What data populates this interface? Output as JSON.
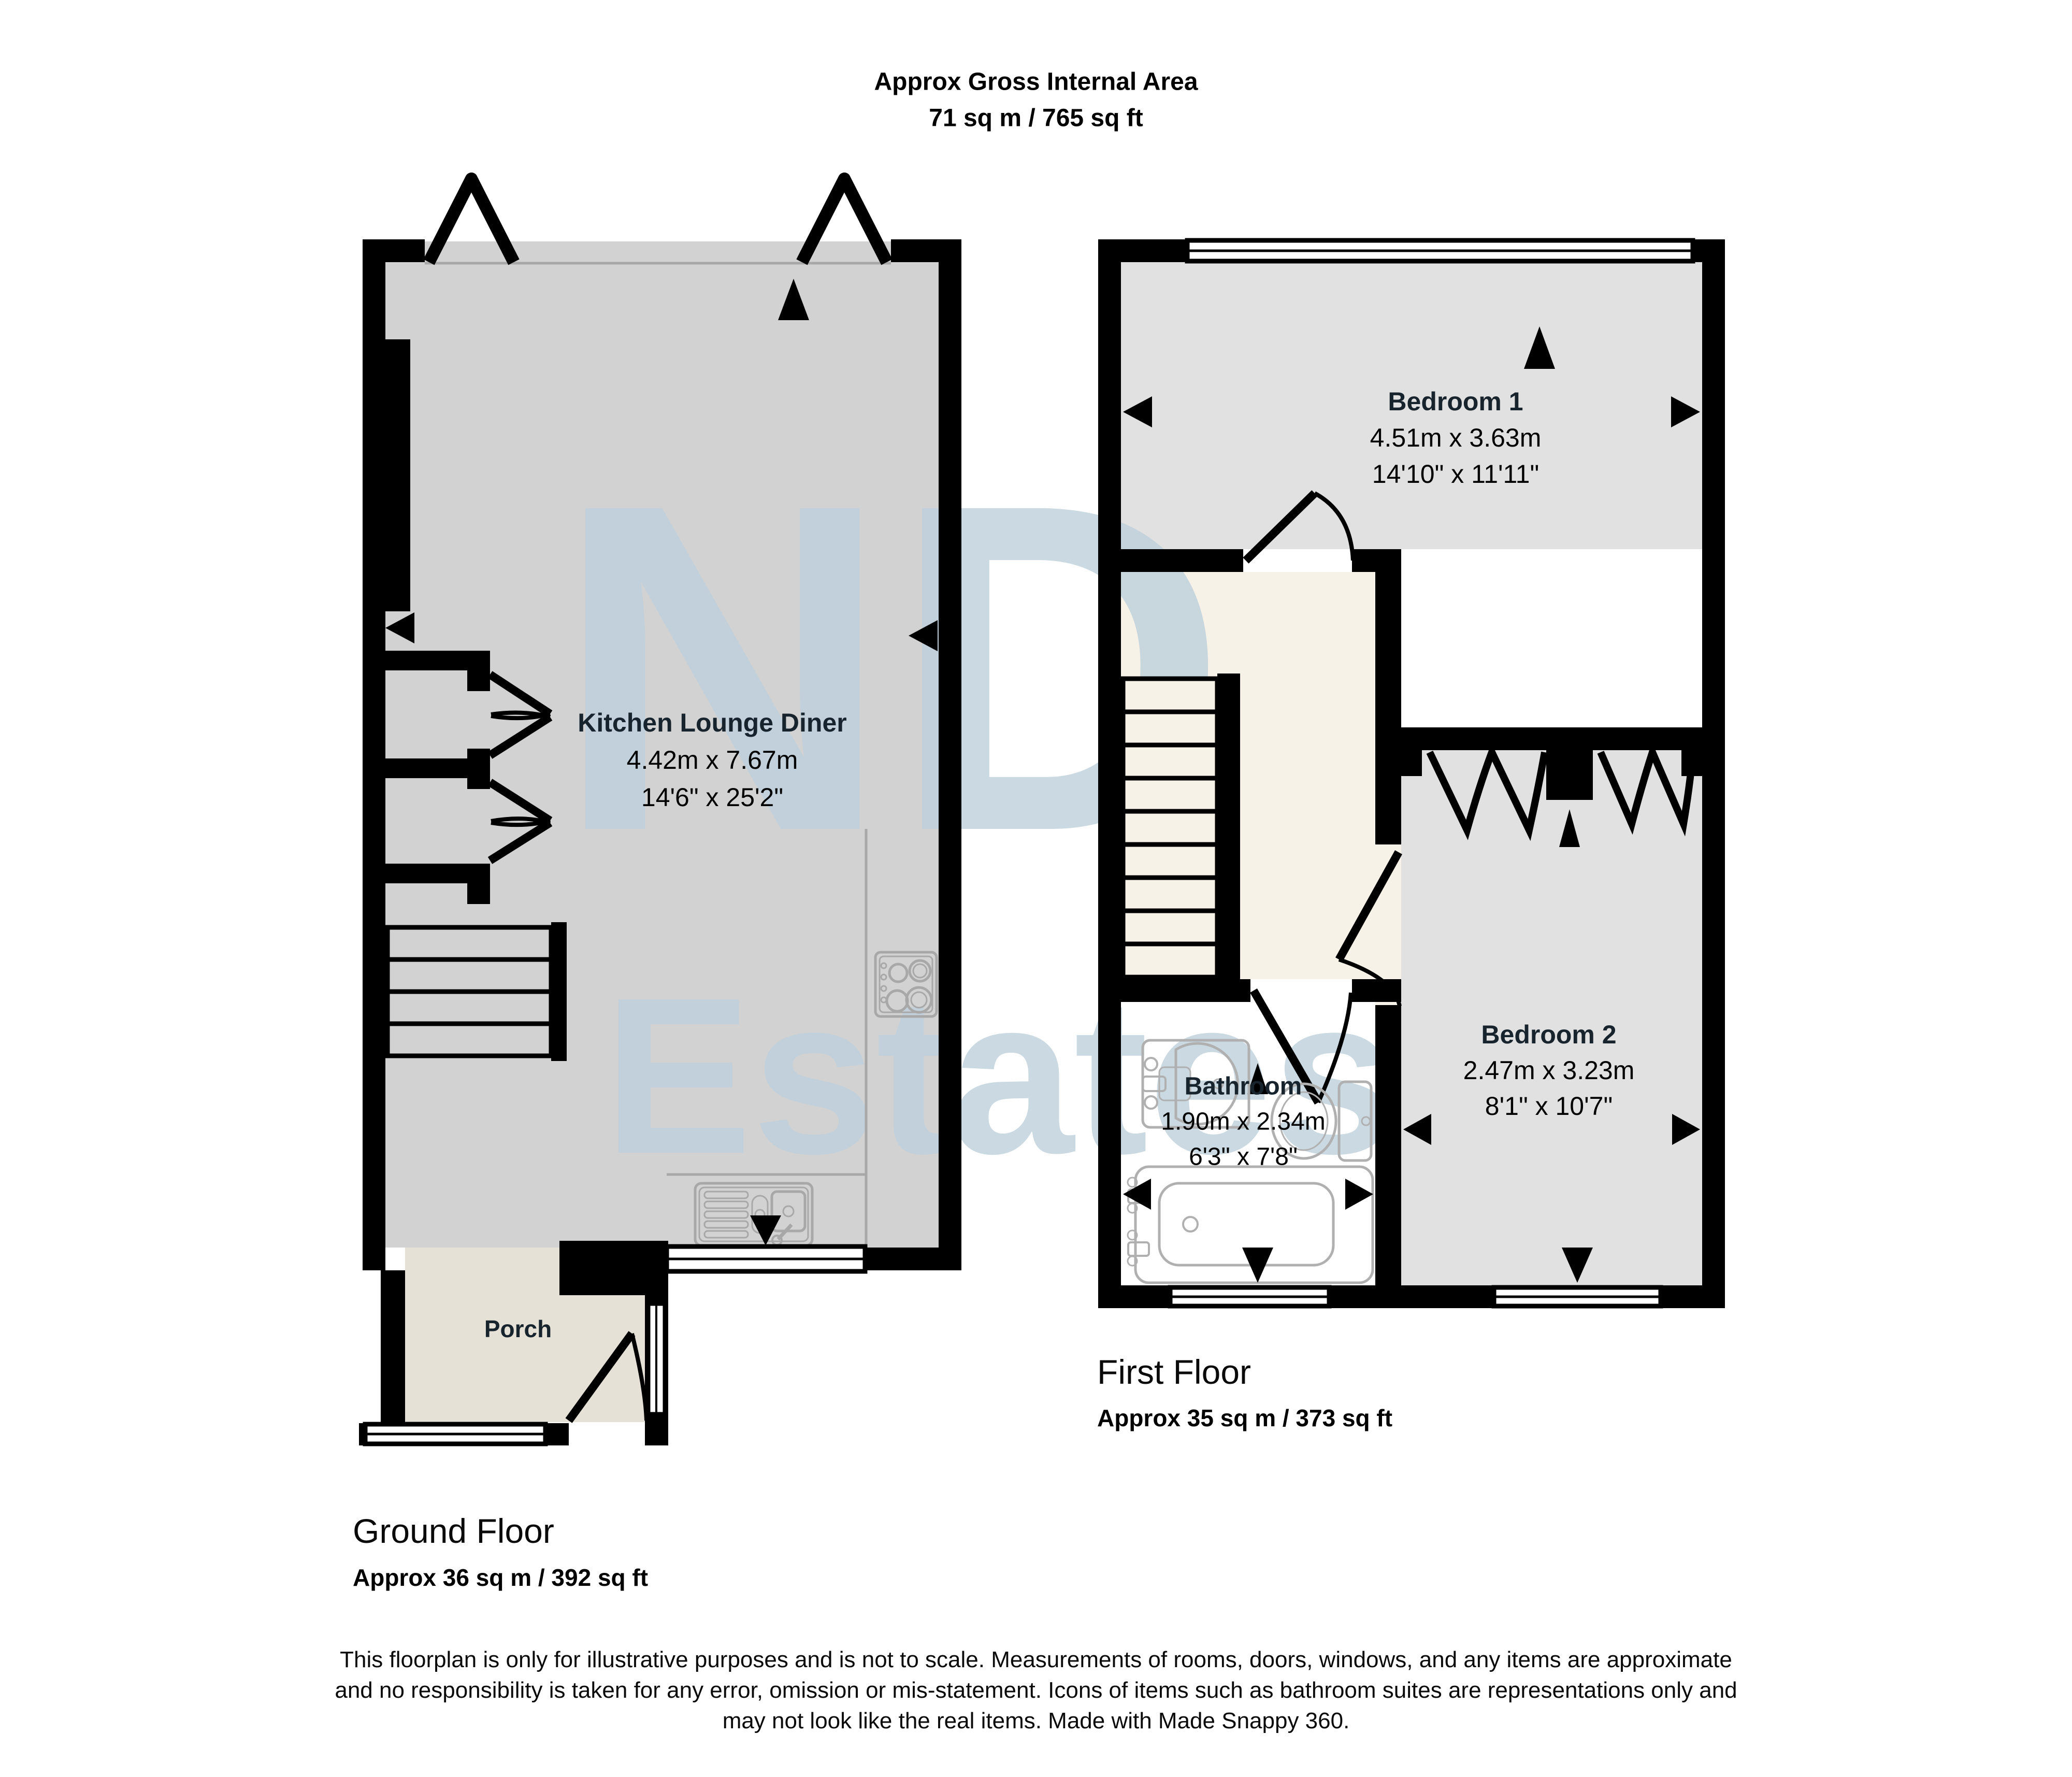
{
  "title": {
    "line1": "Approx Gross Internal Area",
    "line2": "71 sq m / 765 sq ft"
  },
  "ground_floor": {
    "title": "Ground Floor",
    "area": "Approx 36 sq m / 392 sq ft",
    "rooms": {
      "kitchen": {
        "name": "Kitchen Lounge Diner",
        "metric": "4.42m x 7.67m",
        "imperial": "14'6\" x 25'2\""
      },
      "porch": {
        "name": "Porch"
      }
    }
  },
  "first_floor": {
    "title": "First Floor",
    "area": "Approx 35 sq m / 373 sq ft",
    "rooms": {
      "bedroom1": {
        "name": "Bedroom 1",
        "metric": "4.51m x 3.63m",
        "imperial": "14'10\" x 11'11\""
      },
      "bedroom2": {
        "name": "Bedroom 2",
        "metric": "2.47m x 3.23m",
        "imperial": "8'1\" x 10'7\""
      },
      "bathroom": {
        "name": "Bathroom",
        "metric": "1.90m x 2.34m",
        "imperial": "6'3\" x 7'8\""
      }
    }
  },
  "watermark": {
    "line1": "ND",
    "line2": "Estates"
  },
  "disclaimer": {
    "line1": "This floorplan is only for illustrative purposes and is not to scale. Measurements of rooms, doors, windows, and any items are approximate",
    "line2": "and no responsibility is taken for any error, omission or mis-statement. Icons of items such as bathroom suites are representations only and",
    "line3": "may not look like the real items. Made with Made Snappy 360."
  },
  "colors": {
    "wall": "#000000",
    "kitchen_floor": "#d2d2d2",
    "bedroom_floor": "#e1e1e1",
    "landing_floor": "#f7f2e8",
    "porch_floor": "#e5e1d6",
    "bathroom_floor": "#ffffff",
    "watermark": "#bdd0dc",
    "fixture_line": "#a8a8a8",
    "room_name_text": "#17242e"
  }
}
